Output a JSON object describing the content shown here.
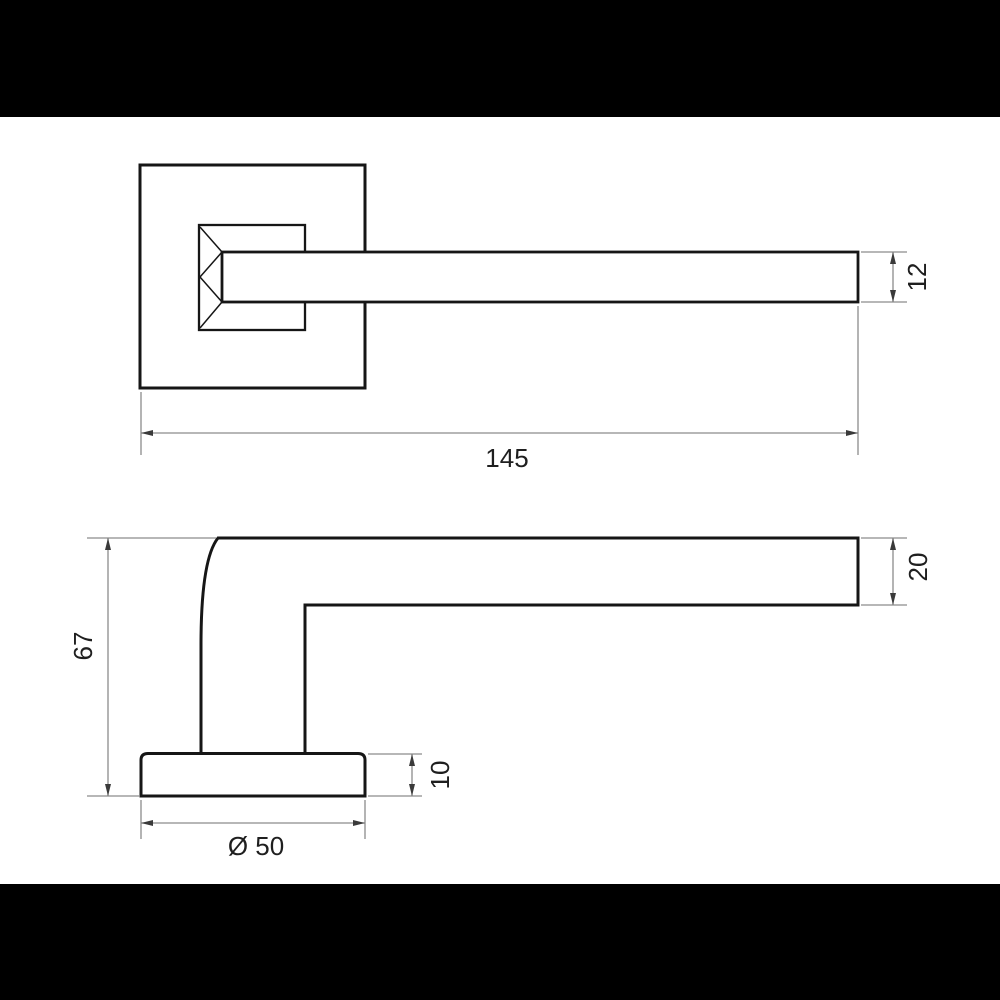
{
  "colors": {
    "background": "#ffffff",
    "letterbox": "#000000",
    "outline": "#161616",
    "dim_line": "#8c8c8c",
    "arrow": "#3a3a3a",
    "label": "#1f1f1f"
  },
  "top_view": {
    "length_label": "145",
    "lever_thickness_label": "12"
  },
  "side_view": {
    "overall_height_label": "67",
    "lever_height_label": "20",
    "rosette_thickness_label": "10",
    "rosette_diameter_label": "Ø 50"
  }
}
